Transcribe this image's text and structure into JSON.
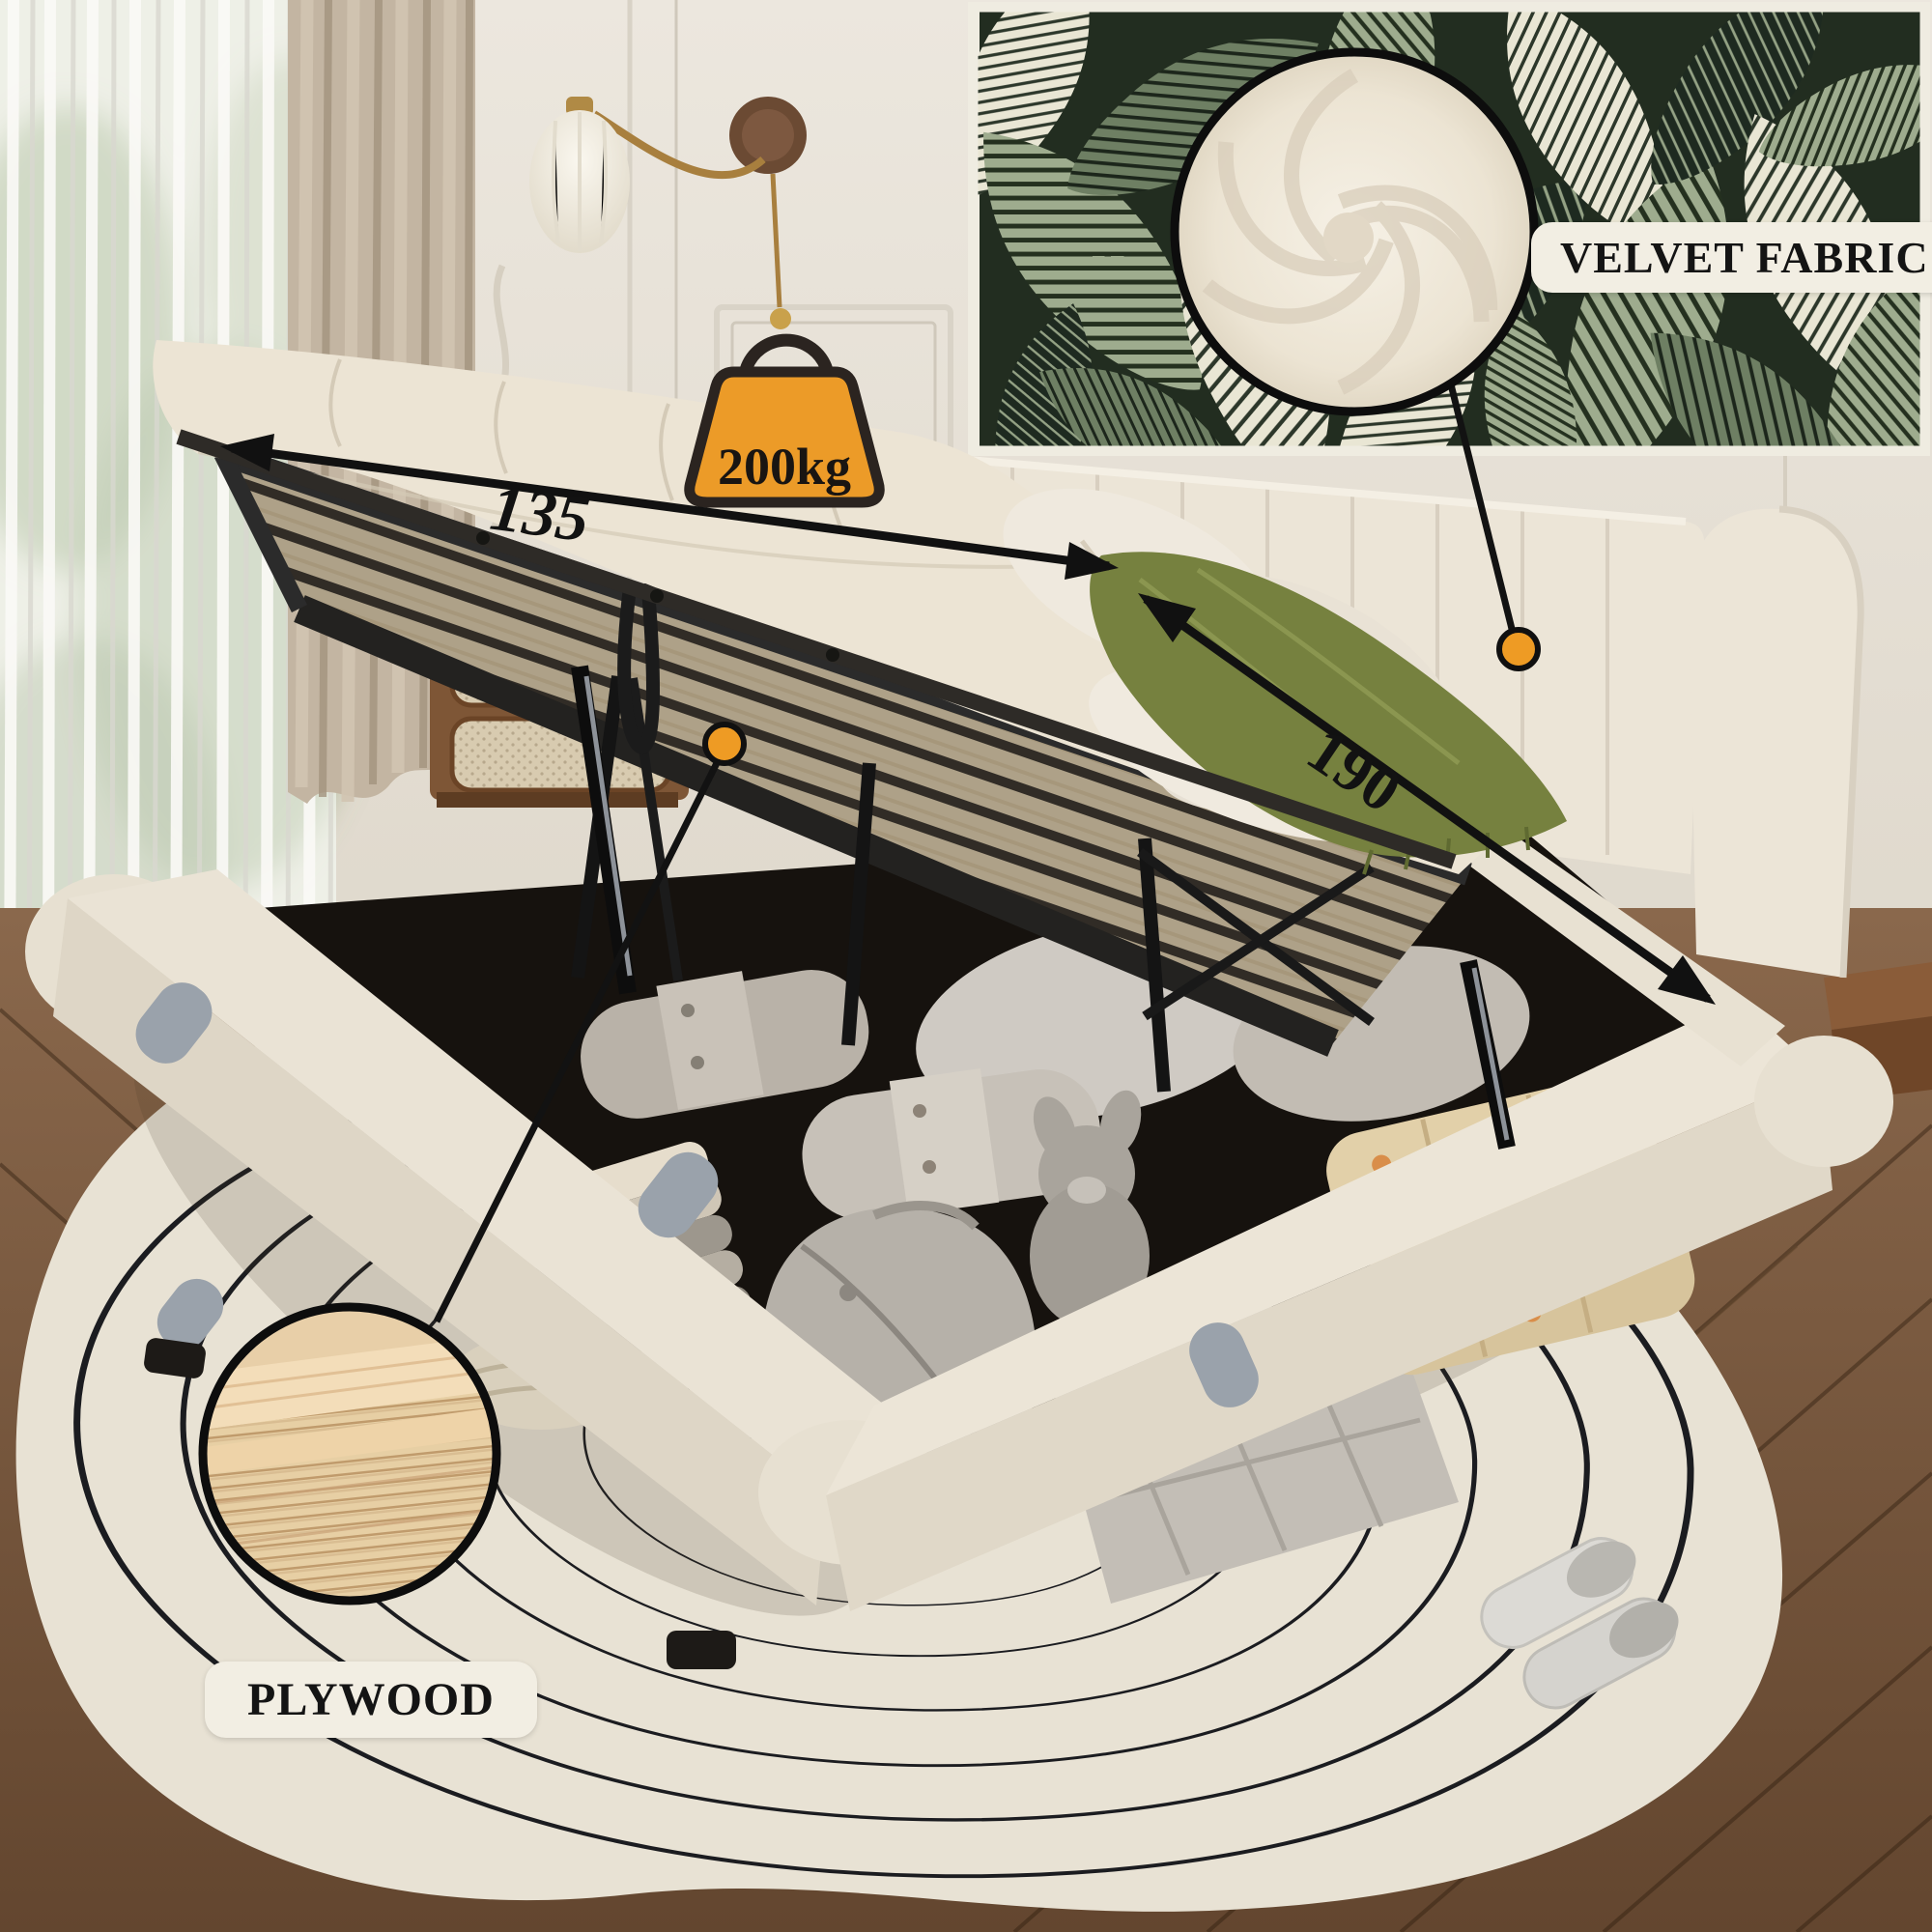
{
  "image": {
    "kind": "annotated product photo",
    "subject": "upholstered lift-up storage platform bed in bedroom"
  },
  "labels": {
    "fabric_callout": "VELVET FABRIC",
    "plywood_callout": "PLYWOOD",
    "max_load_badge": "200kg",
    "width_value": "135",
    "length_value": "190"
  },
  "icons": {
    "weight_badge": "weight-kettlebell-icon",
    "fabric_anchor": "orange-dot-marker",
    "plywood_anchor": "orange-dot-marker",
    "dimension_arrows": "double-headed-arrow"
  },
  "colors": {
    "callout_orange": "#EE9B24",
    "annotation_black": "#121212",
    "label_background": "#F2EEE3",
    "label_text": "#141414",
    "bed_velvet_cream": "#ECE4D4",
    "mural_green_dark": "#222D20",
    "mural_leaf_sage": "#9EAC8E",
    "throw_blanket_olive": "#76813F",
    "rug_cream": "#E8E2D4",
    "rug_line_black": "#1B1C20",
    "floor_wood_brown": "#7C5C41"
  }
}
